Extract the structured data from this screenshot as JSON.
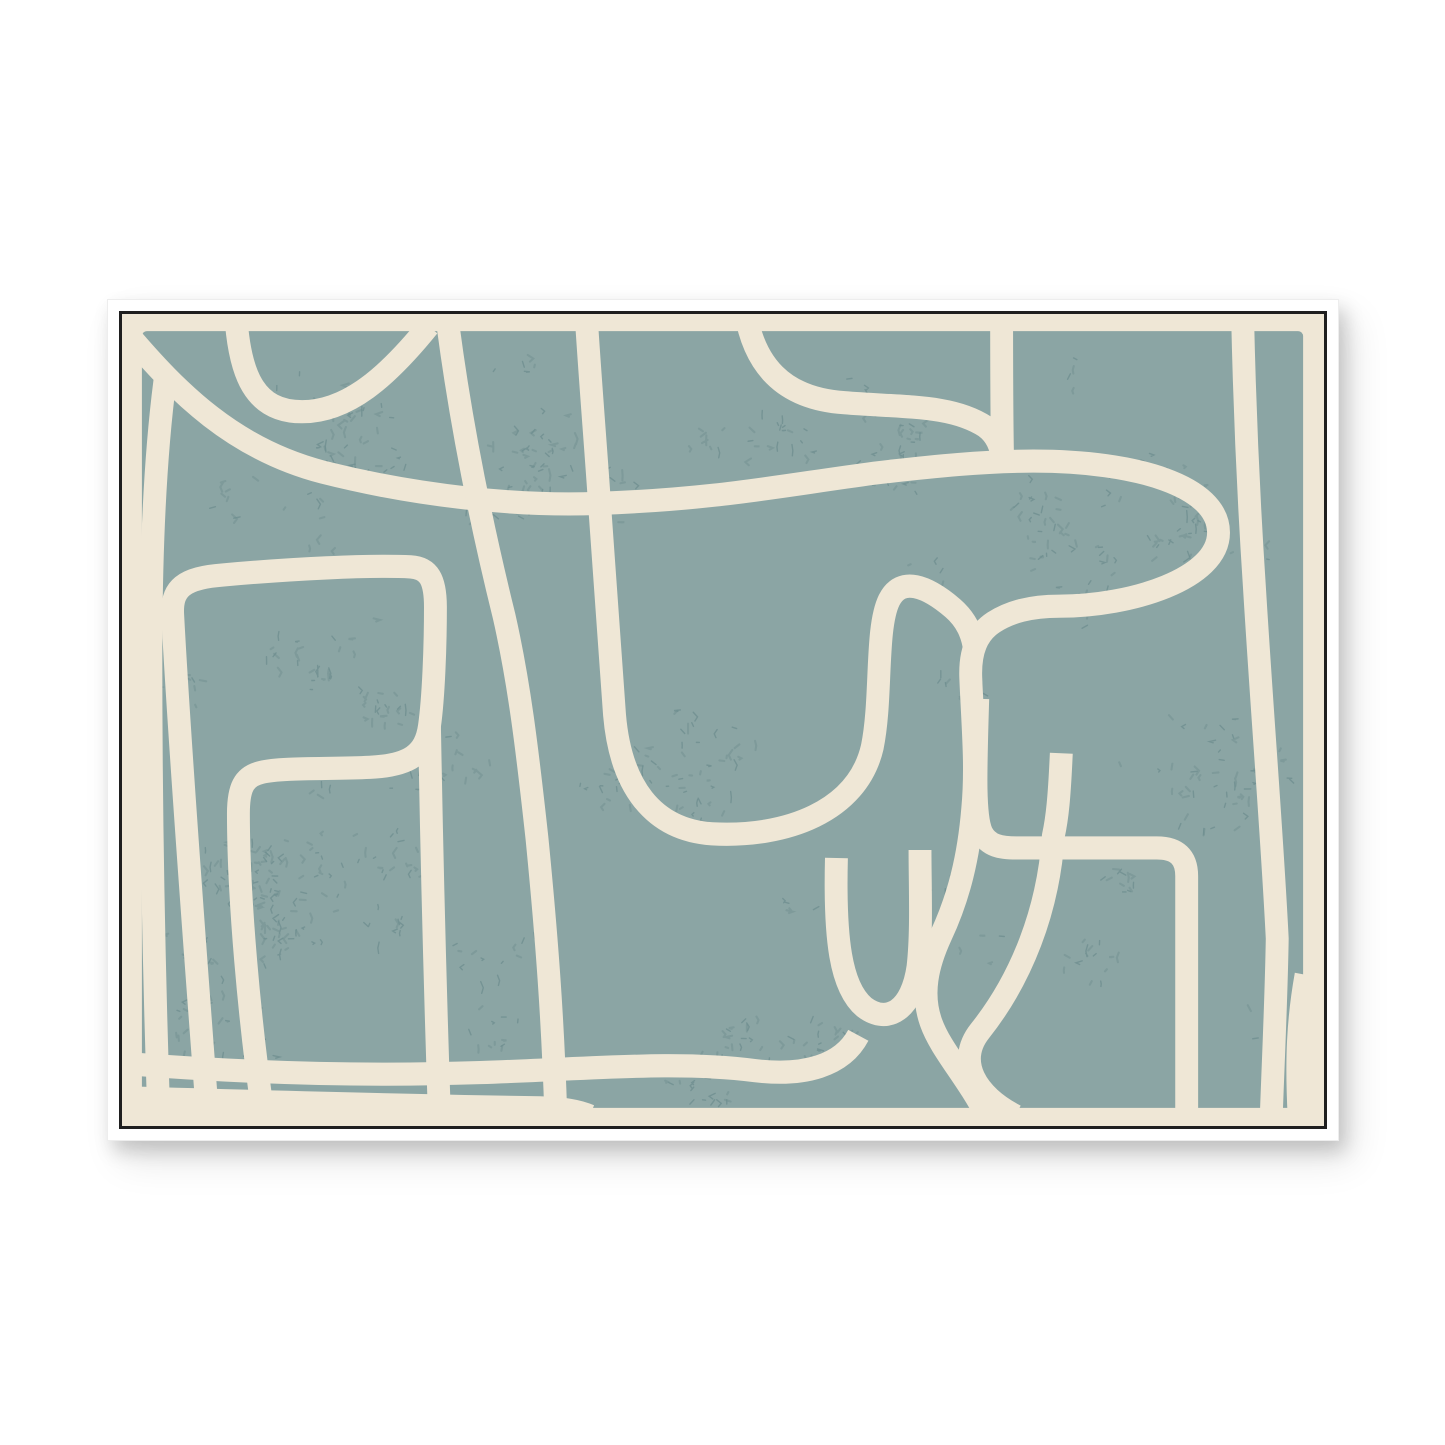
{
  "page": {
    "background_color": "#ffffff"
  },
  "frame": {
    "outer_color": "#ffffff",
    "outer_edge_color": "#ededed",
    "inner_line_color": "#1f1f1f",
    "shadow": "soft gray drop shadow to bottom-right"
  },
  "artwork": {
    "style": "abstract organic line art print",
    "canvas_color": "#efe7d6",
    "panel_color": "#8ba5a4",
    "line_color": "#efe7d6",
    "speckle_color": "#6e8d8f",
    "stroke_width": 23,
    "viewbox": [
      0,
      0,
      1208,
      806
    ],
    "panel": {
      "x": 20,
      "y": 17,
      "w": 1167,
      "h": 771,
      "rx": 5
    },
    "paths": [
      "M 114,-6 C 117,62 134,97 181,97 C 227,97 267,62 308,12",
      "M 6,20 C 56,78 112,134 202,157 C 298,181 398,191 478,188 C 596,184 658,171 756,158 C 816,151 868,146 916,146 C 1020,146 1102,171 1102,217 C 1102,263 1014,290 942,290 C 912,290 892,296 876,306 C 859,317 852,335 853,361 C 855,409 859,449 855,491 C 851,539 841,579 823,617 C 809,647 803,675 813,703 C 823,731 849,757 869,796",
      "M 626,-6 C 634,50 664,84 726,88 C 788,93 834,90 868,112 C 879,120 884,132 885,146",
      "M 884,-6 C 884,46 884,100 885,146",
      "M 328,14 C 342,118 364,220 384,300 C 399,365 407,430 417,520 C 427,620 433,700 436,796",
      "M 466,-6 C 470,60 476,130 480,190 C 487,280 491,340 495,398 C 501,468 533,512 593,516 C 667,520 739,494 754,430 C 764,382 757,312 771,284 C 783,260 809,270 835,292 C 849,304 855,318 857,334",
      "M 860,382 C 858,450 856,498 864,515 C 871,528 883,530 899,530 L 1040,530 C 1060,530 1070,539 1070,558 L 1070,796",
      "M 944,436 C 942,480 940,500 936,518 C 931,592 904,660 862,712 C 838,742 858,776 898,796",
      "M 44,60 C 33,140 29,240 29,340 C 29,480 31,620 37,796",
      "M 86,796 C 74,640 58,430 51,300 C 49,272 62,262 102,259 C 170,253 248,249 290,251 C 308,252 315,263 315,291 C 315,331 313,381 309,409 C 305,437 289,448 249,450 C 209,452 161,450 140,455 C 122,459 117,471 117,496 C 117,580 128,700 142,796",
      "M 309,409 C 311,520 314,650 319,796",
      "M 4,744 C 120,753 240,757 360,753 C 480,749 556,741 636,751 C 686,757 724,746 740,716",
      "M 718,540 C 716,620 722,668 746,688 C 770,706 794,690 800,648 C 804,613 802,570 802,532",
      "M 4,778 C 140,782 280,786 420,788 C 446,789 458,791 470,796",
      "M 1126,-6 C 1128,90 1132,180 1138,270 C 1146,400 1156,520 1161,620 C 1160,680 1157,740 1155,796",
      "M 1183,796 C 1180,740 1182,700 1190,656"
    ],
    "speckles": {
      "seed": 12,
      "clusters": 115,
      "min_marks": 3,
      "max_marks": 14,
      "hotspots": [
        [
          230,
          120
        ],
        [
          430,
          160
        ],
        [
          660,
          130
        ],
        [
          1060,
          190
        ],
        [
          1150,
          430
        ],
        [
          250,
          340
        ],
        [
          150,
          560
        ],
        [
          340,
          640
        ],
        [
          630,
          730
        ],
        [
          900,
          630
        ],
        [
          1090,
          470
        ],
        [
          760,
          90
        ],
        [
          540,
          410
        ],
        [
          120,
          700
        ],
        [
          980,
          240
        ],
        [
          300,
          480
        ]
      ]
    }
  }
}
